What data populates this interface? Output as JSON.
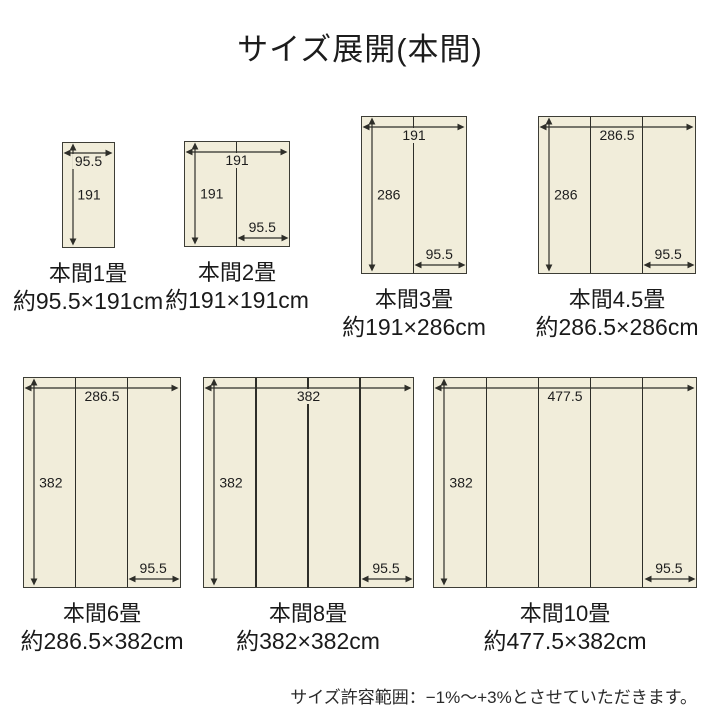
{
  "title": "サイズ展開(本間)",
  "footnote": "サイズ許容範囲：−1%～+3%とさせていただきます。",
  "colors": {
    "mat_fill": "#f1edda",
    "mat_border": "#3d3d36",
    "dim_line": "#2e2e29",
    "text": "#1c1c1c"
  },
  "diagrams": [
    {
      "id": "honma-1jo",
      "name": "本間1畳",
      "size": "約95.5×191cm",
      "width_cm": 95.5,
      "height_cm": 191,
      "panels": 1,
      "labels": {
        "width": "95.5",
        "height": "191",
        "panel": ""
      }
    },
    {
      "id": "honma-2jo",
      "name": "本間2畳",
      "size": "約191×191cm",
      "width_cm": 191,
      "height_cm": 191,
      "panels": 2,
      "labels": {
        "width": "191",
        "height": "191",
        "panel": "95.5"
      }
    },
    {
      "id": "honma-3jo",
      "name": "本間3畳",
      "size": "約191×286cm",
      "width_cm": 191,
      "height_cm": 286,
      "panels": 2,
      "labels": {
        "width": "191",
        "height": "286",
        "panel": "95.5"
      }
    },
    {
      "id": "honma-4-5jo",
      "name": "本間4.5畳",
      "size": "約286.5×286cm",
      "width_cm": 286.5,
      "height_cm": 286,
      "panels": 3,
      "labels": {
        "width": "286.5",
        "height": "286",
        "panel": "95.5"
      }
    },
    {
      "id": "honma-6jo",
      "name": "本間6畳",
      "size": "約286.5×382cm",
      "width_cm": 286.5,
      "height_cm": 382,
      "panels": 3,
      "labels": {
        "width": "286.5",
        "height": "382",
        "panel": "95.5"
      }
    },
    {
      "id": "honma-8jo",
      "name": "本間8畳",
      "size": "約382×382cm",
      "width_cm": 382,
      "height_cm": 382,
      "panels": 4,
      "labels": {
        "width": "382",
        "height": "382",
        "panel": "95.5"
      }
    },
    {
      "id": "honma-10jo",
      "name": "本間10畳",
      "size": "約477.5×382cm",
      "width_cm": 477.5,
      "height_cm": 382,
      "panels": 5,
      "labels": {
        "width": "477.5",
        "height": "382",
        "panel": "95.5"
      }
    }
  ]
}
